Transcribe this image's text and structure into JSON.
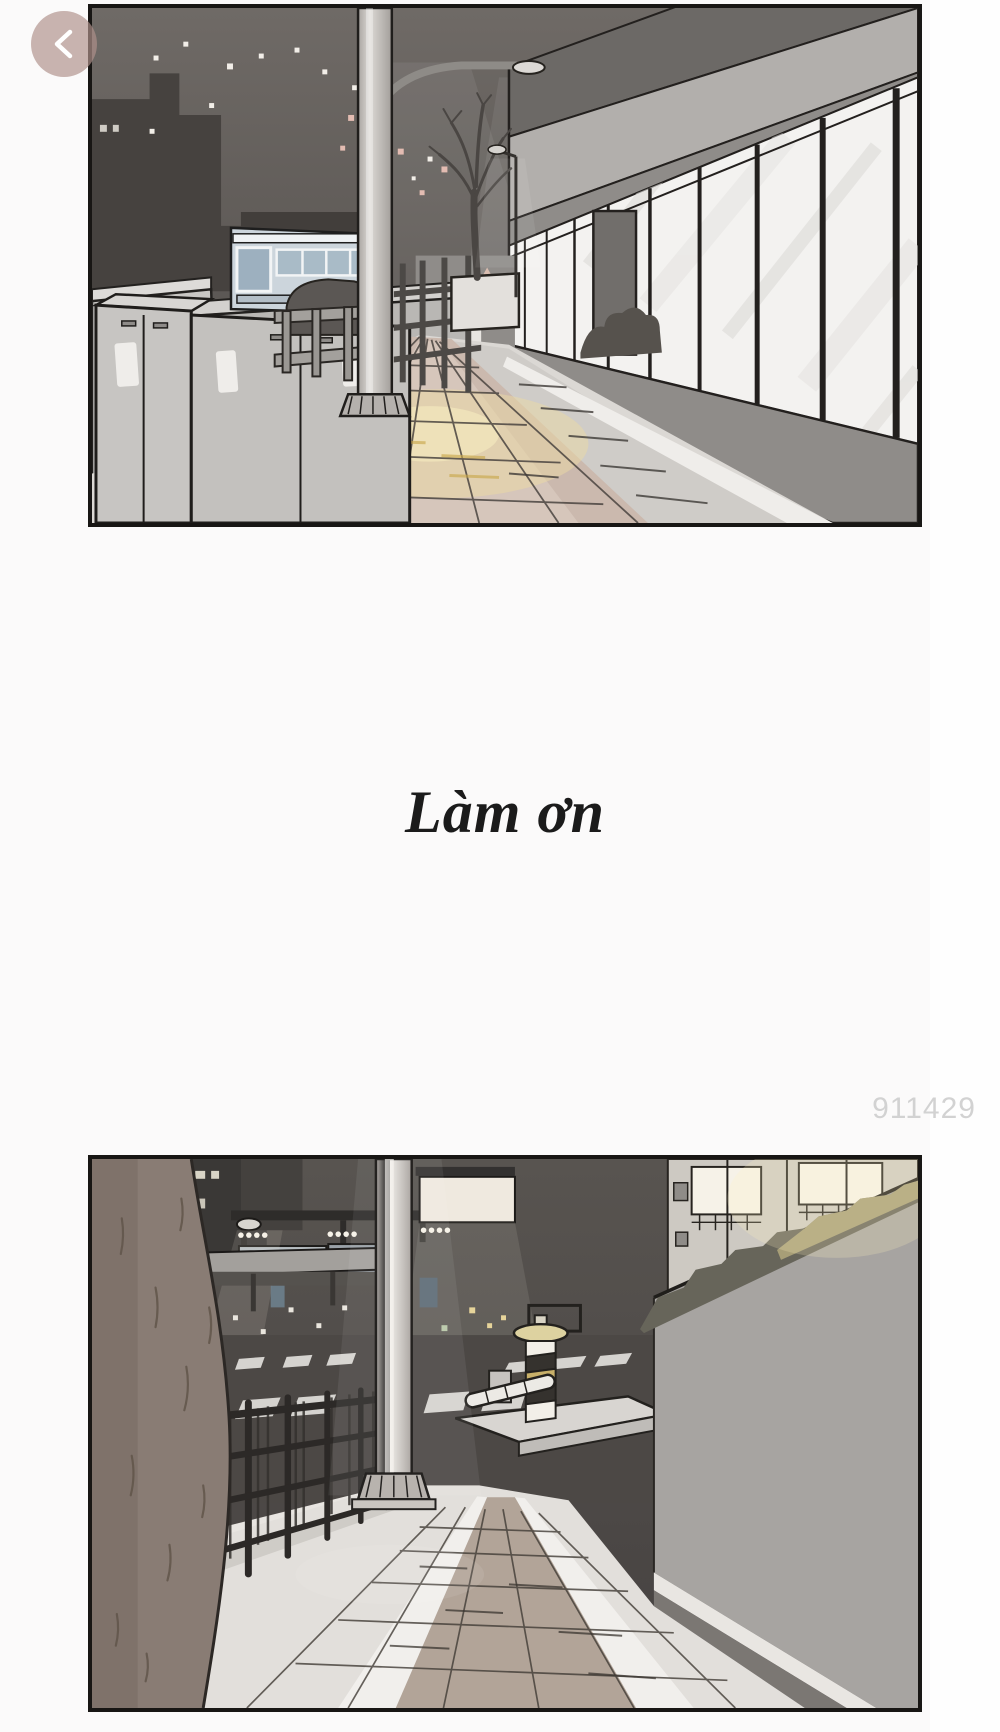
{
  "reader": {
    "back_button": {
      "icon": "chevron-left",
      "bg_color": "rgba(176,144,138,0.68)",
      "icon_color": "#ffffff"
    }
  },
  "comic": {
    "caption": {
      "text": "Làm ơn",
      "color": "#1b1b1b"
    },
    "watermark": {
      "text": "911429",
      "color": "#d2d2d2"
    },
    "panel_border_color": "#181614",
    "panels": [
      {
        "id": "panel-1",
        "scene": "night-street-with-bus-and-storefront"
      },
      {
        "id": "panel-2",
        "scene": "night-street-with-tree-trunk-fence-and-wall"
      }
    ]
  },
  "palette": {
    "page_background": "#fefefe",
    "image_strip_background": "#fbfafa",
    "night_sky": "#67625e",
    "sidewalk_pink": "#cbb9ae",
    "sidewalk_glow": "#ecd9a4",
    "pole_gray": "#cfccc8",
    "wall_gray": "#a7a4a1",
    "trunk_brown": "#897c74"
  }
}
